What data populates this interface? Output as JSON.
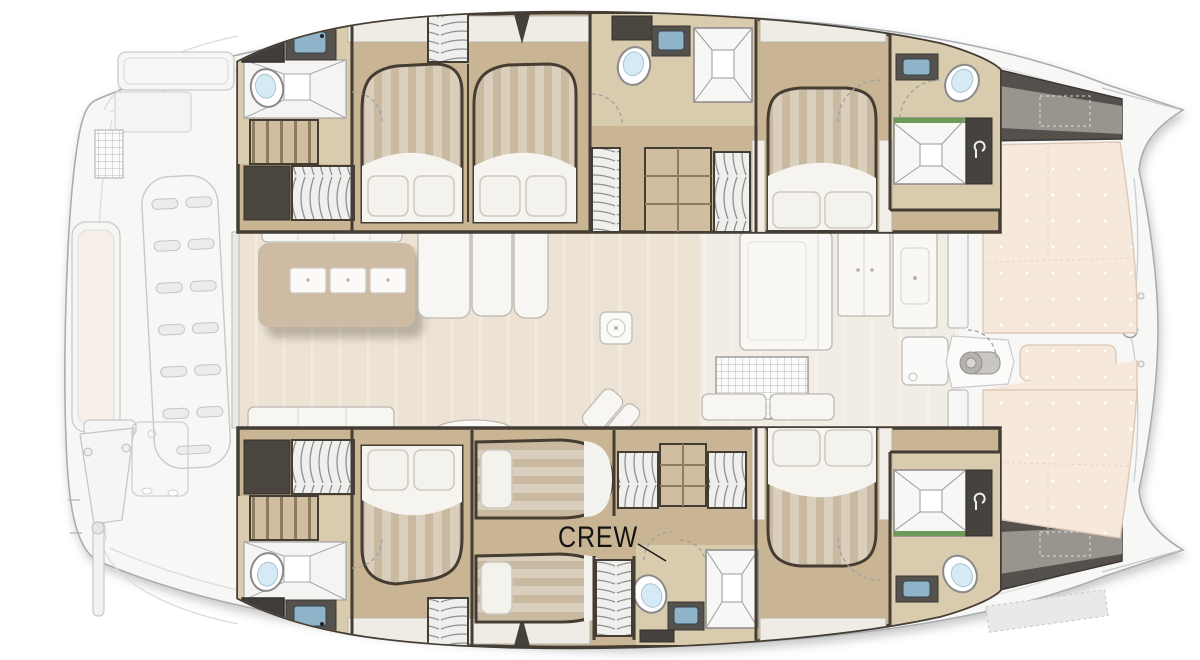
{
  "diagram": {
    "type": "catamaran-yacht-deck-plan",
    "label_crew": "CREW",
    "colors": {
      "background": "#ffffff",
      "hull_fill": "#f7f7f6",
      "hull_stroke": "#a8adb0",
      "cabin_wood": "#c9b593",
      "bath_wood": "#d9cbae",
      "salon_floor": "#ece3d4",
      "galley_floor": "#f2ede4",
      "wall_dark": "#443d34",
      "bed_stripe_light": "#d9cfbc",
      "bed_stripe_dark": "#c8b9a0",
      "linen_white": "#f6f4ef",
      "sunpad": "#f6e8db",
      "sink_blue": "#8fb3c9",
      "shower_green": "#6b9b57",
      "dark_unit": "#46423e",
      "steps_gray": "#55504b"
    }
  }
}
